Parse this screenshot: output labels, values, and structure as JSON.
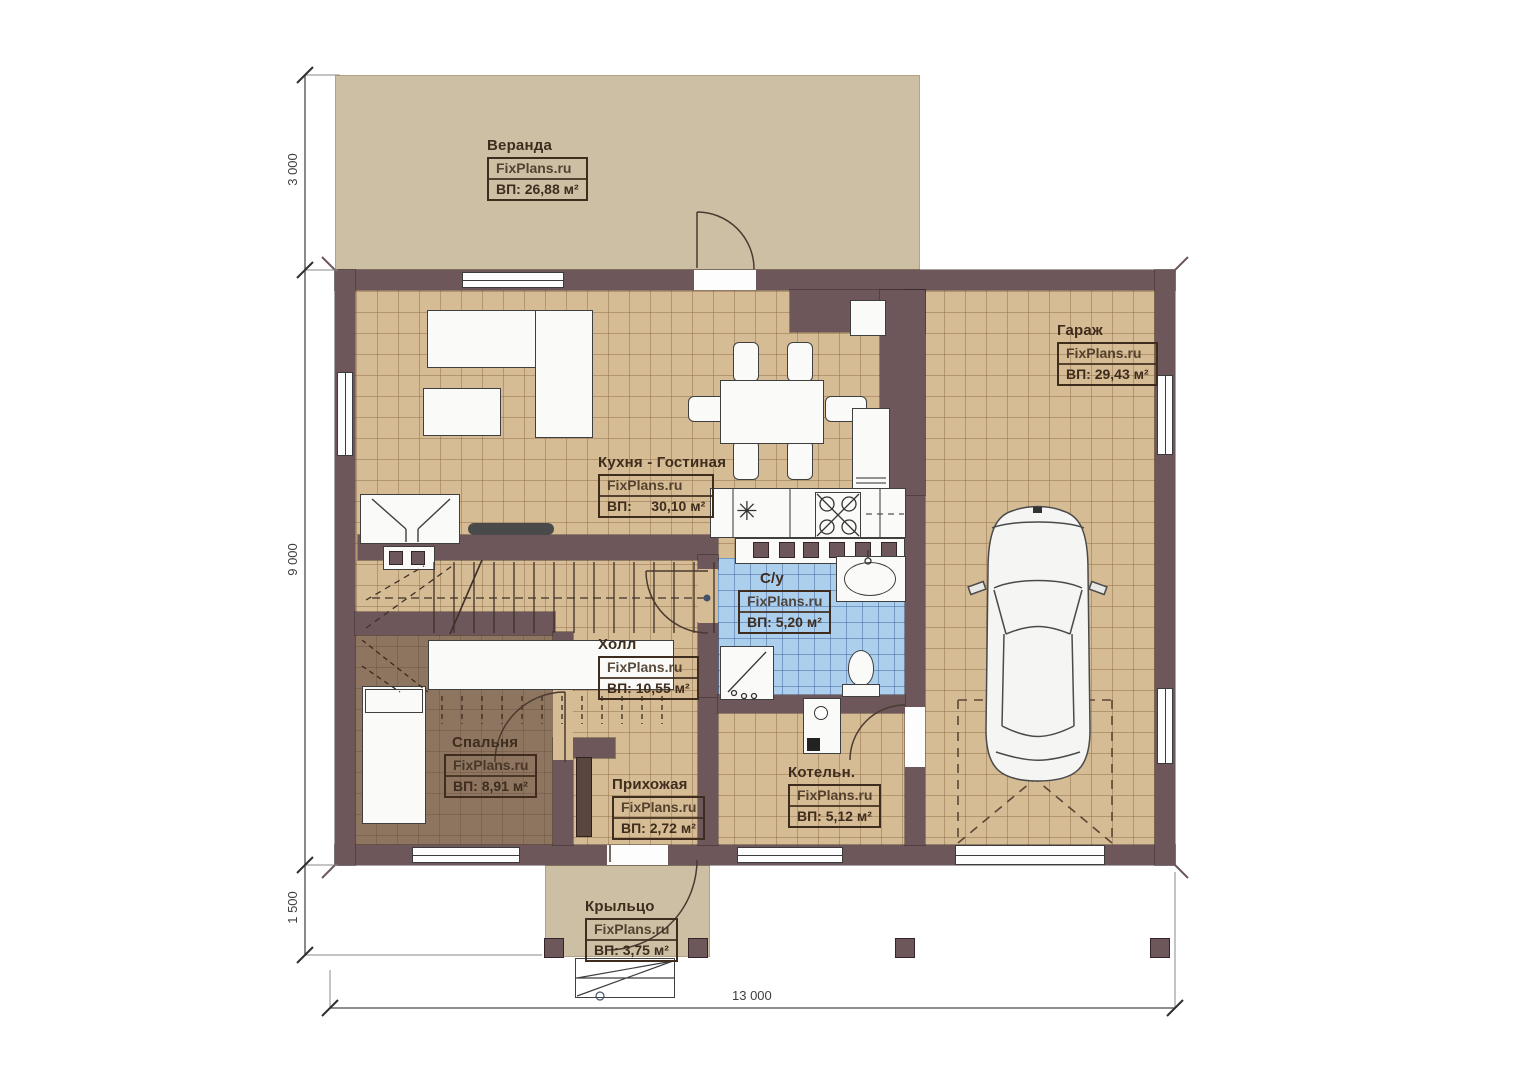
{
  "meta": {
    "type": "floor-plan",
    "brand": "FixPlans.ru"
  },
  "rooms": [
    {
      "key": "veranda",
      "name": "Веранда",
      "brand": "FixPlans.ru",
      "area": "ВП: 26,88 м²"
    },
    {
      "key": "garage",
      "name": "Гараж",
      "brand": "FixPlans.ru",
      "area": "ВП: 29,43 м²"
    },
    {
      "key": "kitchen_living",
      "name": "Кухня - Гостиная",
      "brand": "FixPlans.ru",
      "area": "ВП:     30,10 м²"
    },
    {
      "key": "bathroom",
      "name": "С/у",
      "brand": "FixPlans.ru",
      "area": "ВП: 5,20 м²"
    },
    {
      "key": "hall",
      "name": "Холл",
      "brand": "FixPlans.ru",
      "area": "ВП: 10,55 м²"
    },
    {
      "key": "bedroom",
      "name": "Спальня",
      "brand": "FixPlans.ru",
      "area": "ВП: 8,91 м²"
    },
    {
      "key": "entry",
      "name": "Прихожая",
      "brand": "FixPlans.ru",
      "area": "ВП: 2,72 м²"
    },
    {
      "key": "boiler",
      "name": "Котельн.",
      "brand": "FixPlans.ru",
      "area": "ВП: 5,12 м²"
    },
    {
      "key": "porch",
      "name": "Крыльцо",
      "brand": "FixPlans.ru",
      "area": "ВП: 3,75 м²"
    }
  ],
  "dimensions": {
    "veranda_depth": "3 000",
    "house_depth": "9 000",
    "porch_depth": "1 500",
    "total_width": "13 000"
  },
  "colors": {
    "wall": "#6e575b",
    "floor_tile": "#d6bc94",
    "veranda_floor": "#cdbfa3",
    "bedroom_floor": "#8e7560",
    "bathroom_floor": "#accfee",
    "label_ink": "#3e2d1e"
  }
}
